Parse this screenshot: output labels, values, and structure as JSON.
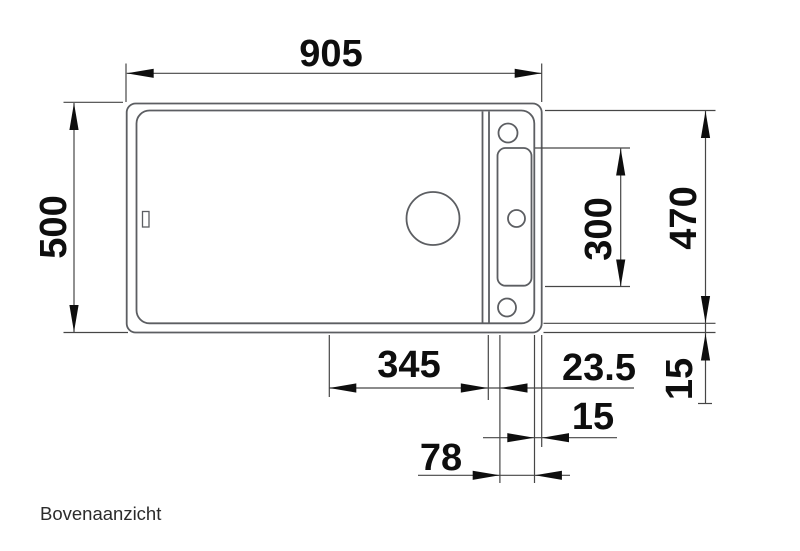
{
  "title": "Bovenaanzicht",
  "dimensions": {
    "overall_width": "905",
    "overall_depth": "500",
    "tap_ledge_length": "300",
    "inner_depth": "470",
    "rim_right_vertical": "15",
    "bowl_width": "345",
    "offset_right": "23.5",
    "rim_right_horizontal": "15",
    "ledge_width": "78"
  },
  "colors": {
    "background": "#ffffff",
    "sink_outline": "#5c5e62",
    "dimension_lines": "#464646",
    "arrows_and_text": "#0e0e0e"
  }
}
